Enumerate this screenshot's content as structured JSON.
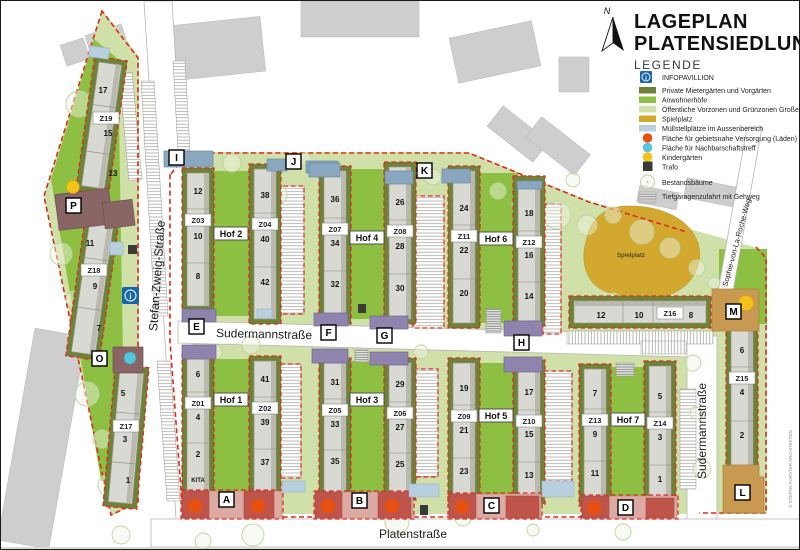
{
  "title": {
    "line1": "LAGEPLAN",
    "line2": "PLATENSIEDLUNG"
  },
  "legend": {
    "heading": "LEGENDE",
    "items": [
      {
        "id": "infopavillion",
        "label": "INFOPAVILLION"
      },
      {
        "id": "private-gardens",
        "label": "Private Mietergärten und Vorgärten"
      },
      {
        "id": "anwohnerhoefe",
        "label": "Anwohnerhöfe"
      },
      {
        "id": "public-zones",
        "label": "Öffentliche Vorzonen und Grünzonen Großer"
      },
      {
        "id": "spielplatz",
        "label": "Spielplatz"
      },
      {
        "id": "muell",
        "label": "Müllstellplätze im Aussenbereich"
      },
      {
        "id": "laeden",
        "label": "Fläche für gebietsnahe Versorgung (Läden)"
      },
      {
        "id": "nachbarschaft",
        "label": "Fläche für Nachbarschaftstreff"
      },
      {
        "id": "kindergarten",
        "label": "Kindergärten"
      },
      {
        "id": "trafo",
        "label": "Trafo"
      },
      {
        "id": "bestandsbaeume",
        "label": "Bestandsbäume"
      },
      {
        "id": "tiefgarage",
        "label": "Tiefgaragenzufahrt mit Gehweg"
      }
    ]
  },
  "misc": {
    "north": "N",
    "playground": "Spielplatz",
    "kita": "KITA",
    "credit": "© STEFAN FORSTER ARCHITEKTEN"
  },
  "streets": {
    "stefan_zweig": "Stefan-Zweig-Straße",
    "sudermann": "Sudermannstraße",
    "platen": "Platenstraße",
    "sophie": "Sophie-von-La-Roche-Weg"
  },
  "map": {
    "hofs": {
      "h1": "Hof 1",
      "h2": "Hof 2",
      "h3": "Hof 3",
      "h4": "Hof 4",
      "h5": "Hof 5",
      "h6": "Hof 6",
      "h7": "Hof 7"
    },
    "markers": {
      "a": "A",
      "b": "B",
      "c": "C",
      "d": "D",
      "e": "E",
      "f": "F",
      "g": "G",
      "h": "H",
      "i": "I",
      "j": "J",
      "k": "K",
      "l": "L",
      "m": "M",
      "o": "O",
      "p": "P"
    },
    "buildings": {
      "z01": {
        "label": "Z01",
        "n": [
          "6",
          "4",
          "2"
        ]
      },
      "z02": {
        "label": "Z02",
        "n": [
          "41",
          "39",
          "37"
        ]
      },
      "z03": {
        "label": "Z03",
        "n": [
          "12",
          "10",
          "8"
        ]
      },
      "z04": {
        "label": "Z04",
        "n": [
          "38",
          "40",
          "42"
        ]
      },
      "z05": {
        "label": "Z05",
        "n": [
          "31",
          "33",
          "35"
        ]
      },
      "z06": {
        "label": "Z06",
        "n": [
          "29",
          "27",
          "25"
        ]
      },
      "z07": {
        "label": "Z07",
        "n": [
          "36",
          "34",
          "32"
        ]
      },
      "z08": {
        "label": "Z08",
        "n": [
          "26",
          "28",
          "30"
        ]
      },
      "z09": {
        "label": "Z09",
        "n": [
          "19",
          "21",
          "23"
        ]
      },
      "z10": {
        "label": "Z10",
        "n": [
          "17",
          "15",
          "13"
        ]
      },
      "z11": {
        "label": "Z11",
        "n": [
          "24",
          "22",
          "20"
        ]
      },
      "z12": {
        "label": "Z12",
        "n": [
          "18",
          "16",
          "14"
        ]
      },
      "z13": {
        "label": "Z13",
        "n": [
          "7",
          "9",
          "11"
        ]
      },
      "z14": {
        "label": "Z14",
        "n": [
          "5",
          "3",
          "1"
        ]
      },
      "z15": {
        "label": "Z15",
        "n": [
          "6",
          "4",
          "2"
        ]
      },
      "z16": {
        "label": "Z16",
        "n": [
          "12",
          "10",
          "8"
        ]
      },
      "z17": {
        "label": "Z17",
        "n": [
          "5",
          "3",
          "1"
        ]
      },
      "z18": {
        "label": "Z18",
        "n": [
          "11",
          "9",
          "7"
        ]
      },
      "z19": {
        "label": "Z19",
        "n": [
          "17",
          "15",
          "13"
        ]
      }
    }
  },
  "colors": {
    "private_gardens": "#6f8338",
    "anwohnerhoefe": "#8dc042",
    "public_zones": "#cfe0a8",
    "spielplatz": "#d2a92e",
    "muell": "#b8cfe0",
    "laeden": "#e8500f",
    "nachbarschaft": "#55c4dd",
    "kindergarten": "#f2c218",
    "trafo": "#3a3a38",
    "boundary": "#e0281e",
    "building": "#d9d9d3",
    "context": "#cecece",
    "blue_building": "#8aa7bf",
    "purple_building": "#8e84ad",
    "red_building": "#bf544b",
    "tan_building": "#c89a51",
    "info_blue": "#1566ad"
  }
}
